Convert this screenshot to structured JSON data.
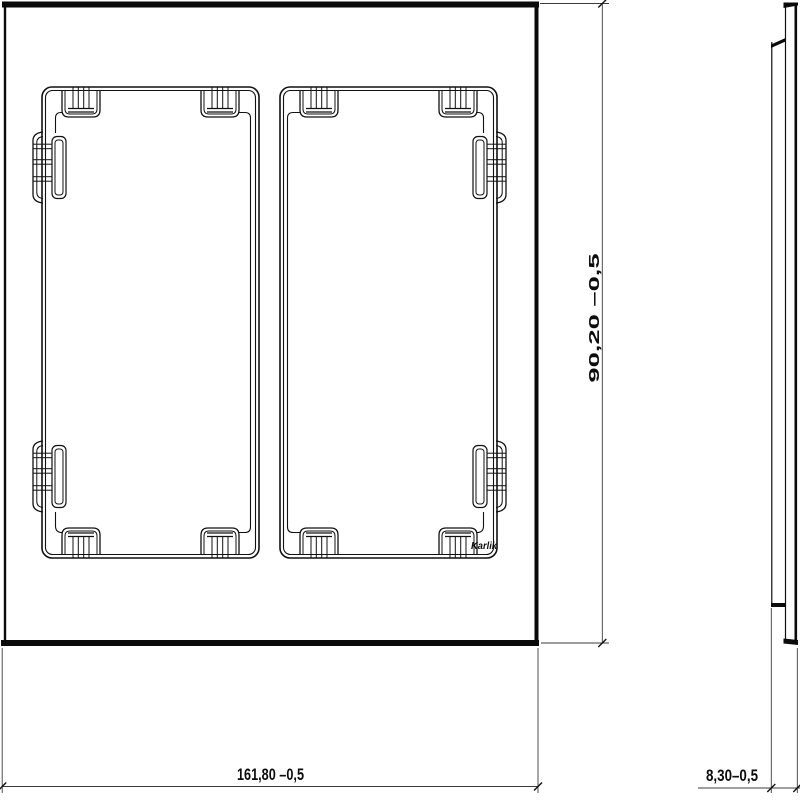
{
  "drawing": {
    "background_color": "#ffffff",
    "line_color": "#111111",
    "dim_line_color": "#3c3c3c",
    "brand": "Karlik",
    "front_view": {
      "description": "two-gang frame front view",
      "openings": 2
    },
    "side_view": {
      "description": "frame profile side view"
    },
    "dimensions": {
      "width": "161,80 –0,5",
      "height": "90,20 –0,5",
      "depth": "8,30–0,5"
    }
  }
}
